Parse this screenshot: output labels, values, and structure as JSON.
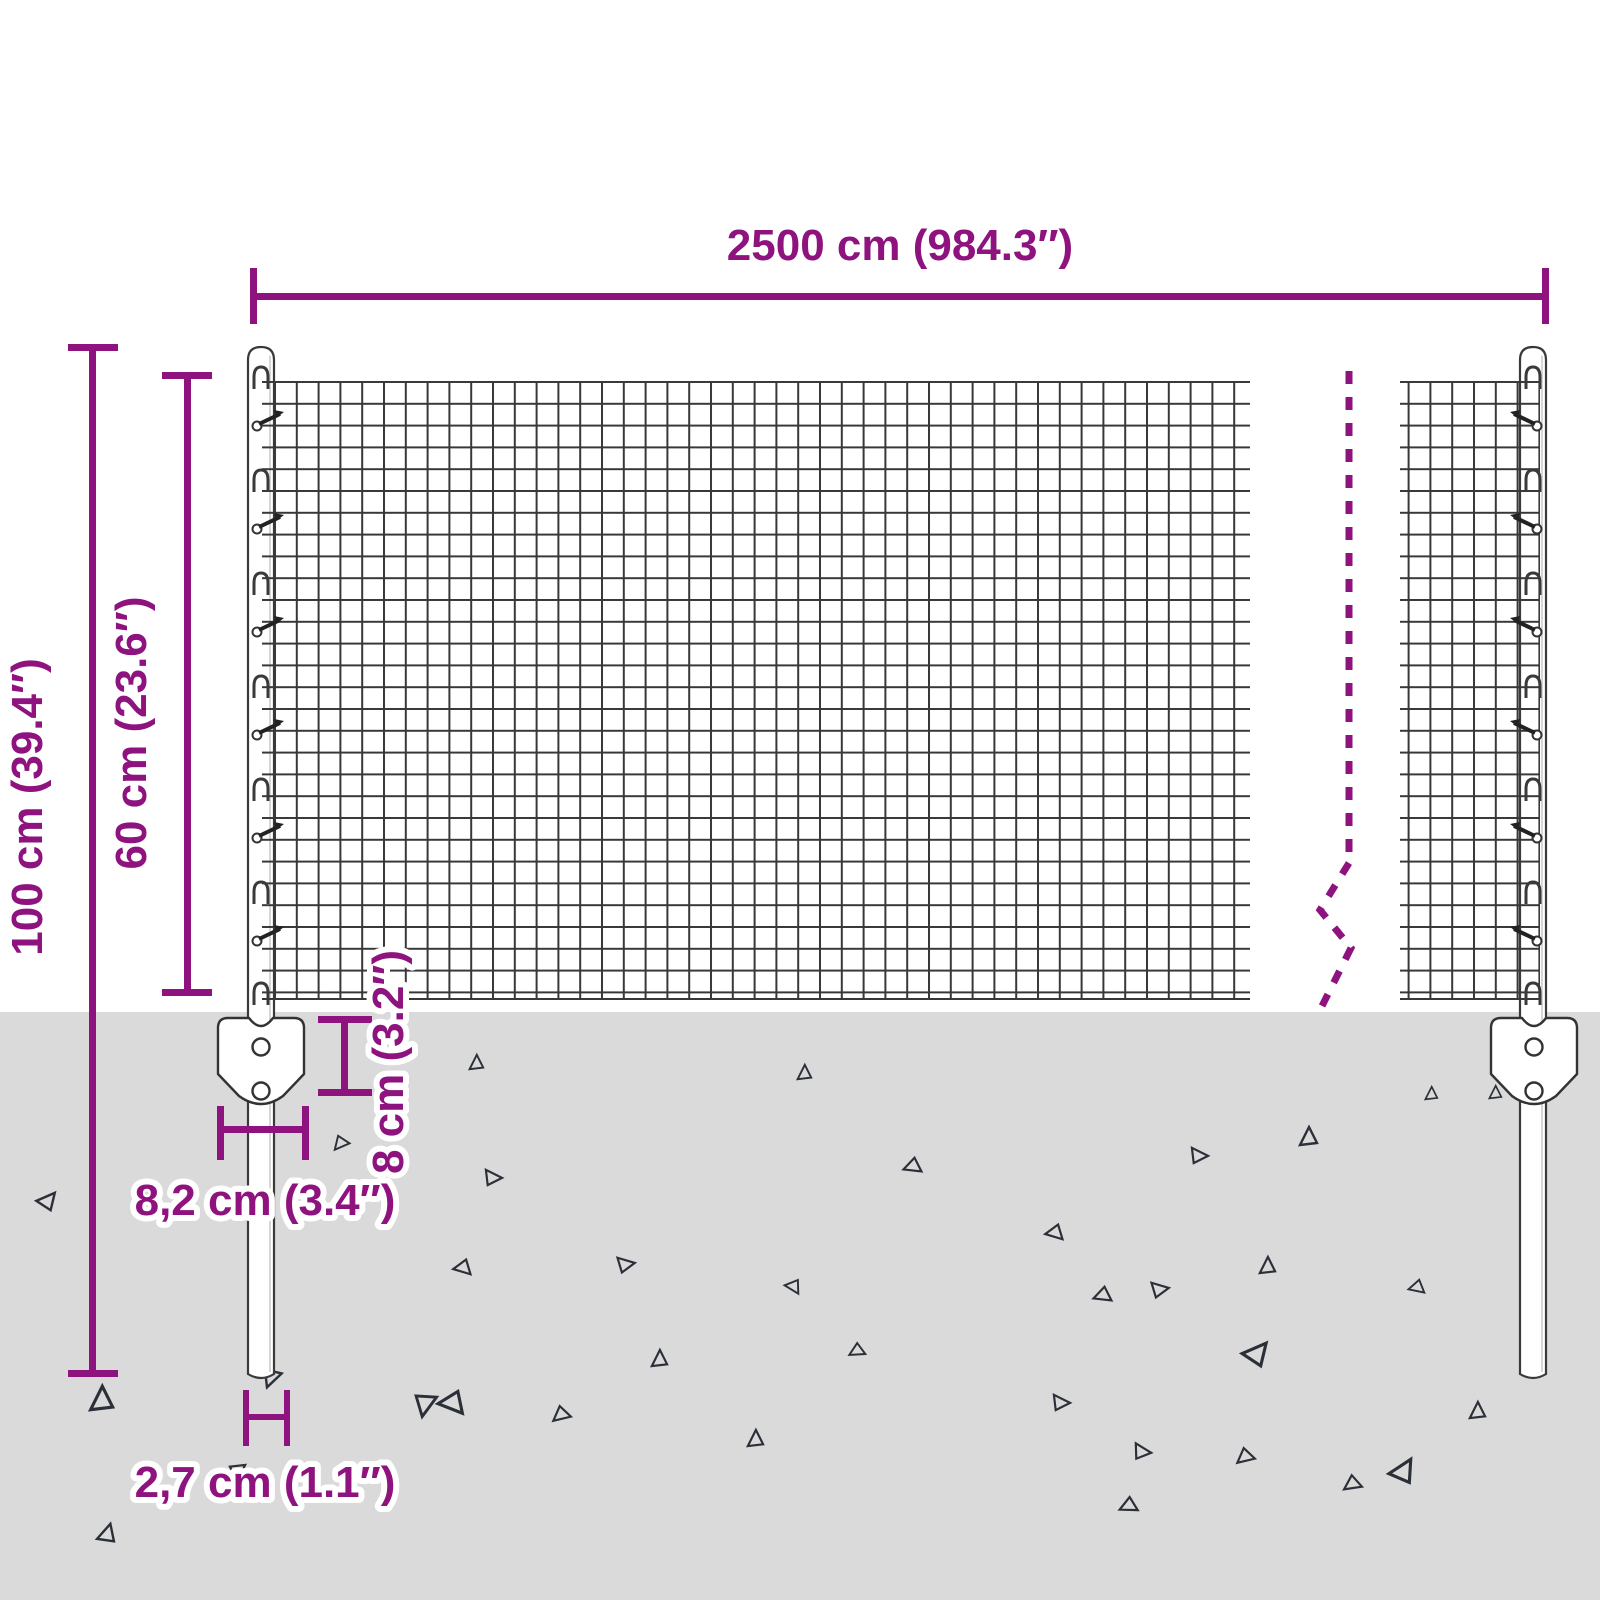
{
  "accent_color": "#8e137f",
  "ground_color": "#dadada",
  "wire_color": "#383838",
  "dimensions": {
    "total_width": {
      "label": "2500 cm (984.3″)",
      "cm": "2500",
      "inches": "984.3"
    },
    "post_height": {
      "label": "100 cm (39.4″)",
      "cm": "100",
      "inches": "39.4"
    },
    "mesh_height": {
      "label": "60 cm (23.6″)",
      "cm": "60",
      "inches": "23.6"
    },
    "bracket_height": {
      "label": "8 cm (3.2″)",
      "cm": "8",
      "inches": "3.2"
    },
    "bracket_width": {
      "label": "8,2 cm (3.4″)",
      "cm": "8,2",
      "inches": "3.4"
    },
    "post_diameter": {
      "label": "2,7 cm (1.1″)",
      "cm": "2,7",
      "inches": "1.1"
    }
  }
}
